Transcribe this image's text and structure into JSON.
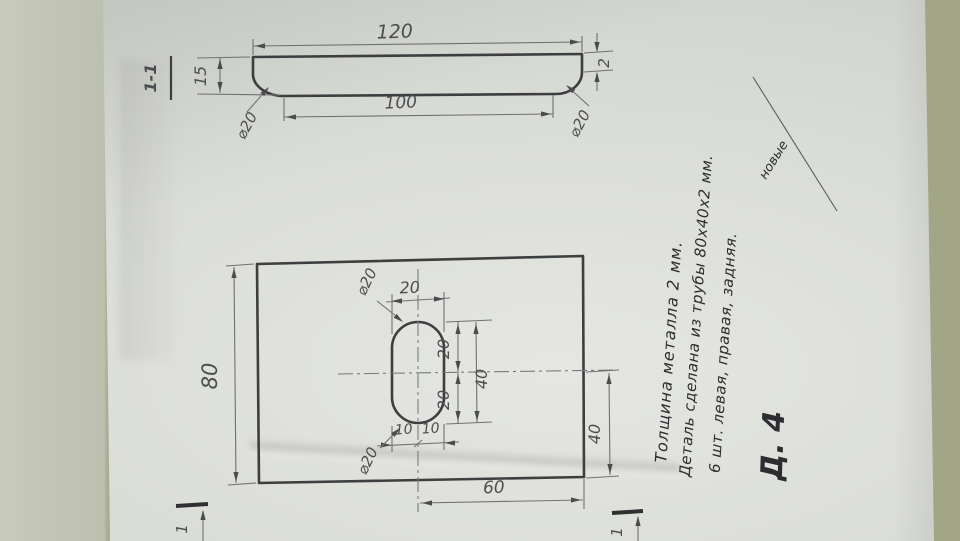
{
  "colors": {
    "paper": "#dbddd8",
    "table_left": "#c8cbbc",
    "table_right": "#a9ac8d",
    "pencil": "#4c4d50",
    "ink": "#2c2d31"
  },
  "section_view": {
    "label": "1-1",
    "dim_overall_width": "120",
    "dim_inner_width": "100",
    "dim_height": "15",
    "dim_thickness": "2",
    "dim_fillet_left": "⌀20",
    "dim_fillet_right": "⌀20"
  },
  "plan_view": {
    "dim_height": "80",
    "dim_slot_width": "20",
    "dim_slot_upper_half": "20",
    "dim_slot_lower_half": "20",
    "dim_slot_length": "40",
    "dim_center_to_right": "60",
    "dim_center_to_bottom": "40",
    "dim_half_left": "10",
    "dim_half_right": "10",
    "dim_slot_radius_top": "⌀20",
    "dim_slot_radius_bottom": "⌀20",
    "section_mark_left": "1",
    "section_mark_right": "1"
  },
  "notes": {
    "line1": "Толщина металла 2 мм.",
    "line2": "Деталь сделана из трубы 80х40х2 мм.",
    "line3": "6 шт. левая, правая, задняя.",
    "part_number": "Д. 4",
    "signature": "новые"
  }
}
